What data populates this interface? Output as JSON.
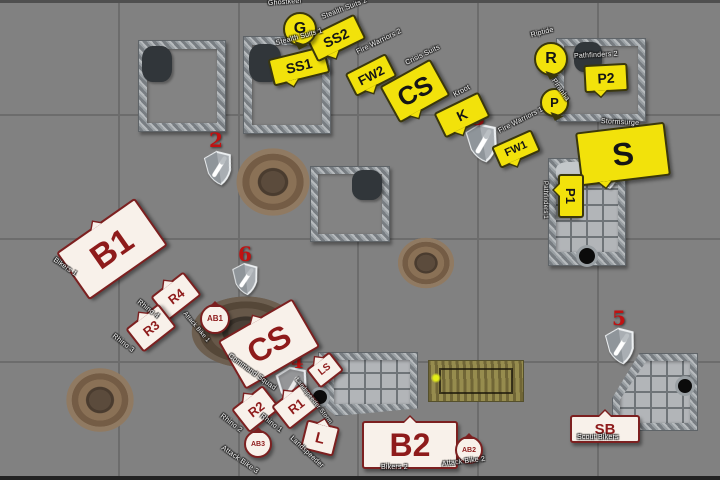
{
  "board": {
    "background_color": "#818181",
    "grid_color": "#6c6c6c",
    "tau_token_color": "#f2e20b",
    "marine_token_color": "#f8f1ea",
    "marine_text_color": "#8e1b1b",
    "objective_number_color": "#c01212",
    "objective_icon": "shield-icon"
  },
  "objectives": [
    {
      "number": ""
    },
    {
      "number": "2"
    },
    {
      "number": "3"
    },
    {
      "number": "4"
    },
    {
      "number": "5"
    },
    {
      "number": "6"
    }
  ],
  "tau": [
    {
      "label": "G",
      "name": "Ghostkeel"
    },
    {
      "label": "SS1",
      "name": "Stealth Suits 1"
    },
    {
      "label": "SS2",
      "name": "Stealth Suits 2"
    },
    {
      "label": "FW2",
      "name": "Fire Warriors 2"
    },
    {
      "label": "CS",
      "name": "Crisis Suits"
    },
    {
      "label": "K",
      "name": "Kroot"
    },
    {
      "label": "FW1",
      "name": "Fire Warriors 1"
    },
    {
      "label": "R",
      "name": "Riptide"
    },
    {
      "label": "P2",
      "name": "Pathfinders 2"
    },
    {
      "label": "P",
      "name": "Piranha"
    },
    {
      "label": "S",
      "name": "Stormsurge"
    },
    {
      "label": "P1",
      "name": "Pathfinders 1"
    }
  ],
  "marines": [
    {
      "label": "B1",
      "name": "Bikers 1"
    },
    {
      "label": "R4",
      "name": "Rhino 4"
    },
    {
      "label": "R3",
      "name": "Rhino 3"
    },
    {
      "label": "AB1",
      "name": "Attack Bike 1"
    },
    {
      "label": "CS",
      "name": "Command Squad"
    },
    {
      "label": "LS",
      "name": "Landspeeder Storm"
    },
    {
      "label": "R2",
      "name": "Rhino 2"
    },
    {
      "label": "R1",
      "name": "Rhino 1"
    },
    {
      "label": "AB3",
      "name": "Attack Bike 3"
    },
    {
      "label": "L",
      "name": "Landspeeder"
    },
    {
      "label": "B2",
      "name": "Bikers 2"
    },
    {
      "label": "AB2",
      "name": "Attack Bike 2"
    },
    {
      "label": "SB",
      "name": "Scout Bikers"
    }
  ]
}
